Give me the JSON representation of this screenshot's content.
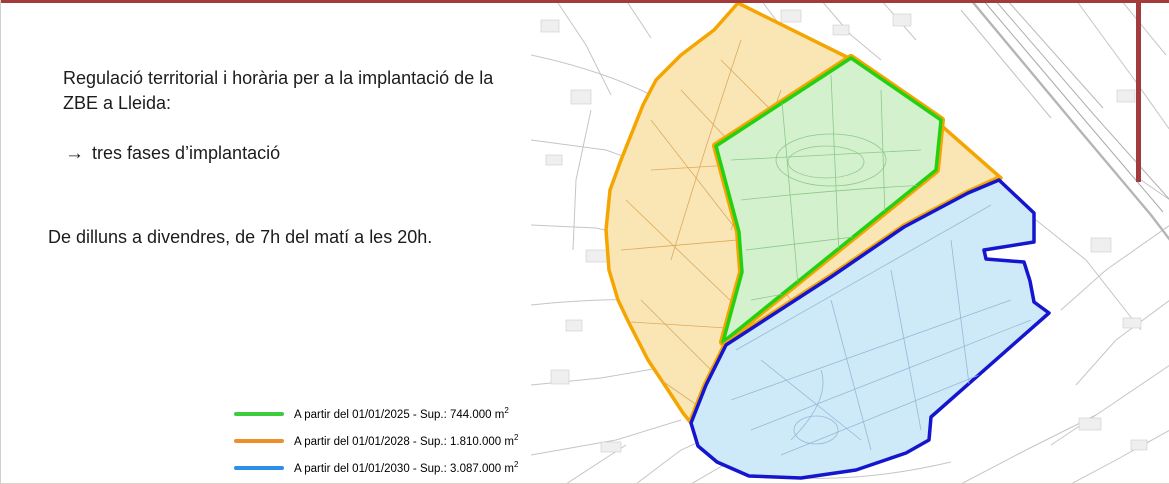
{
  "slide": {
    "title": "Regulació territorial i horària per a la implantació de la ZBE a Lleida:",
    "arrow_glyph": "→",
    "phases_note": "tres fases d’implantació",
    "schedule": "De dilluns a divendres, de 7h del matí a les 20h.",
    "accent_color": "#a23b3b"
  },
  "legend": {
    "items": [
      {
        "label": "A partir del 01/01/2025 - Sup.: 744.000 m",
        "sup": "2",
        "color": "#3ecc3e"
      },
      {
        "label": "A partir del 01/01/2028 - Sup.: 1.810.000 m",
        "sup": "2",
        "color": "#ee8f2e"
      },
      {
        "label": "A partir del 01/01/2030 - Sup.: 3.087.000 m",
        "sup": "2",
        "color": "#2d8fe8"
      }
    ]
  },
  "map": {
    "zones": [
      {
        "name": "zone-2028-orange",
        "fill": "#fae5b4",
        "stroke": "#f5a500"
      },
      {
        "name": "zone-2025-green",
        "fill": "#d4f1cd",
        "stroke": "#24d112"
      },
      {
        "name": "zone-2030-blue",
        "fill": "#cee9f7",
        "stroke": "#1515cf"
      }
    ]
  }
}
